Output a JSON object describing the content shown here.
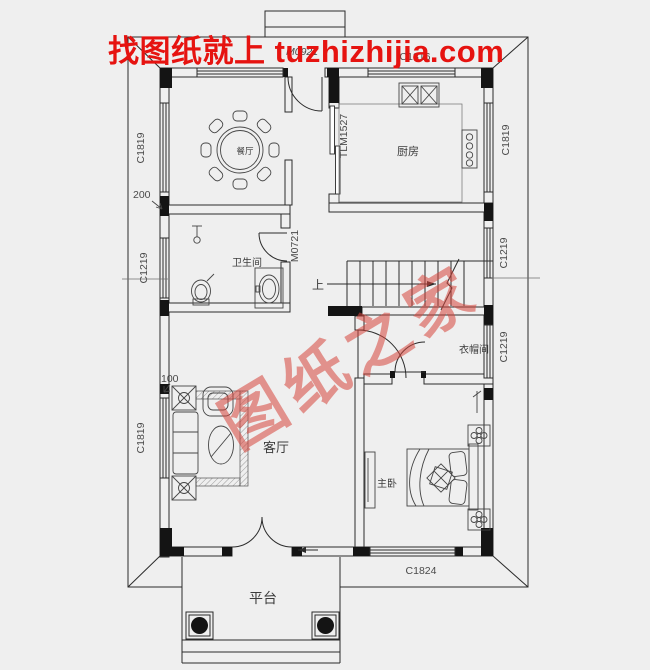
{
  "watermark": {
    "top_text": "找图纸就上 tuzhizhijia.com",
    "top_color": "#e61310",
    "diagonal_text": "图纸之家",
    "diagonal_color": "#d7463c"
  },
  "rooms": {
    "dining": "餐厅",
    "kitchen": "厨房",
    "bathroom": "卫生间",
    "living_room": "客厅",
    "master_bedroom": "主卧",
    "cloakroom": "衣帽间",
    "platform": "平台",
    "stairs_up": "上"
  },
  "openings": {
    "window_left_top": "C1819",
    "window_left_middle": "C1219",
    "window_left_bottom": "C1819",
    "window_right_top": "C1819",
    "window_right_middle": "C1219",
    "window_right_lower": "C1219",
    "window_top_kitchen": "C1816",
    "window_bottom_bedroom": "C1824",
    "door_back": "M0921",
    "door_bathroom": "M0721",
    "sliding_door_kitchen": "TLM1527"
  },
  "dimensions": {
    "offset_200": "200",
    "offset_100": "100"
  }
}
